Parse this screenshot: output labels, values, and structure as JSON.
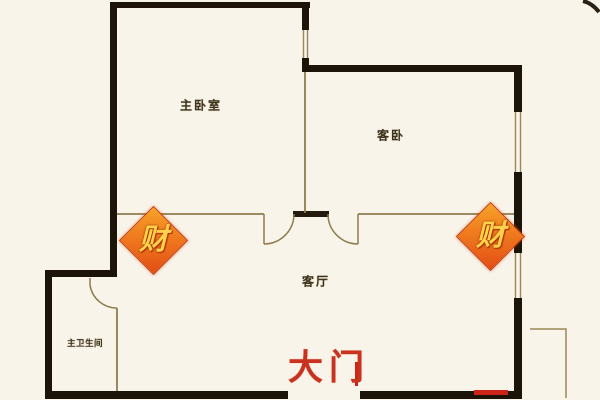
{
  "floorplan": {
    "background_color": "#f8f4e9",
    "wall_color": "#1d1409",
    "thin_line_color": "#8f7c4e",
    "rooms": {
      "master_bedroom": "主卧室",
      "guest_bedroom": "客卧",
      "living_room": "客厅",
      "master_bathroom": "主卫生间"
    },
    "entrance": {
      "label": "大门",
      "color": "#c9321f"
    },
    "charm": {
      "label": "财",
      "text_color": "#ffd24a",
      "bg_color_from": "#f7a429",
      "bg_color_to": "#e34d16"
    }
  }
}
